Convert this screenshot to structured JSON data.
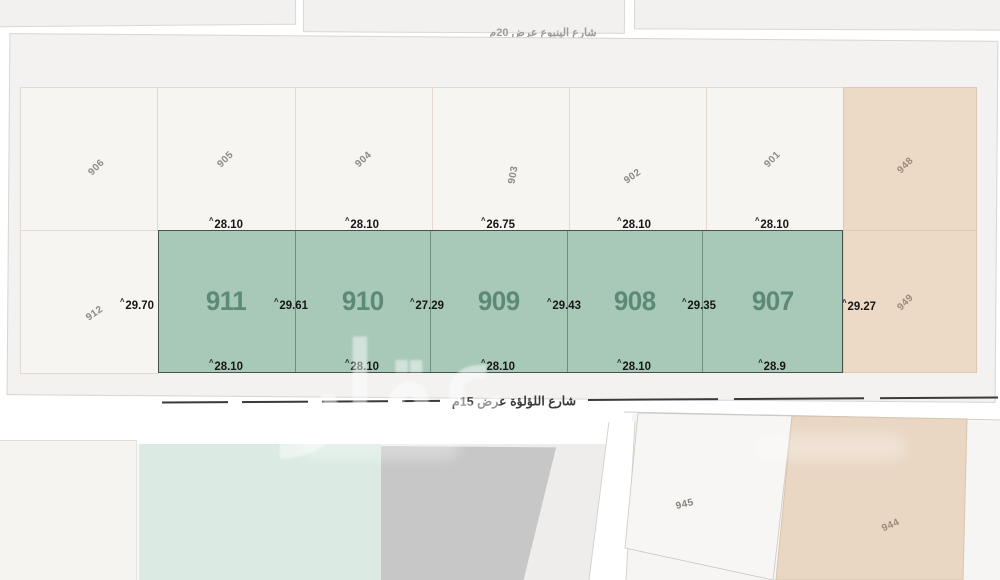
{
  "streets": {
    "top_label": "شارع الينبوع عرض 20م",
    "bottom_label": "شارع اللؤلؤة عرض 15م"
  },
  "watermark": {
    "text": "عقار"
  },
  "dim_prefix": "^",
  "top_row_parcels": [
    {
      "id": "906"
    },
    {
      "id": "905"
    },
    {
      "id": "904"
    },
    {
      "id": "903"
    },
    {
      "id": "902"
    },
    {
      "id": "901"
    },
    {
      "id": "948"
    }
  ],
  "side_parcels": {
    "left": {
      "id": "912"
    },
    "right": {
      "id": "949"
    }
  },
  "green_row": {
    "parcels": [
      {
        "id": "911",
        "top_dim": "28.10",
        "bottom_dim": "28.10",
        "left_dim": "29.70"
      },
      {
        "id": "910",
        "top_dim": "28.10",
        "bottom_dim": "28.10",
        "left_dim": "29.61"
      },
      {
        "id": "909",
        "top_dim": "26.75",
        "bottom_dim": "28.10",
        "left_dim": "27.29"
      },
      {
        "id": "908",
        "top_dim": "28.10",
        "bottom_dim": "28.10",
        "left_dim": "29.43"
      },
      {
        "id": "907",
        "top_dim": "28.10",
        "bottom_dim": "28.9",
        "left_dim": "29.35"
      }
    ],
    "right_dim": "29.27"
  },
  "bottom_block_parcels": [
    {
      "id": "945"
    },
    {
      "id": "944"
    }
  ],
  "colors": {
    "plot_green": "#a8c9b8",
    "plot_beige": "#ecdac6",
    "plot_teal": "#dbeae3",
    "plot_gray": "#c7c7c7"
  }
}
